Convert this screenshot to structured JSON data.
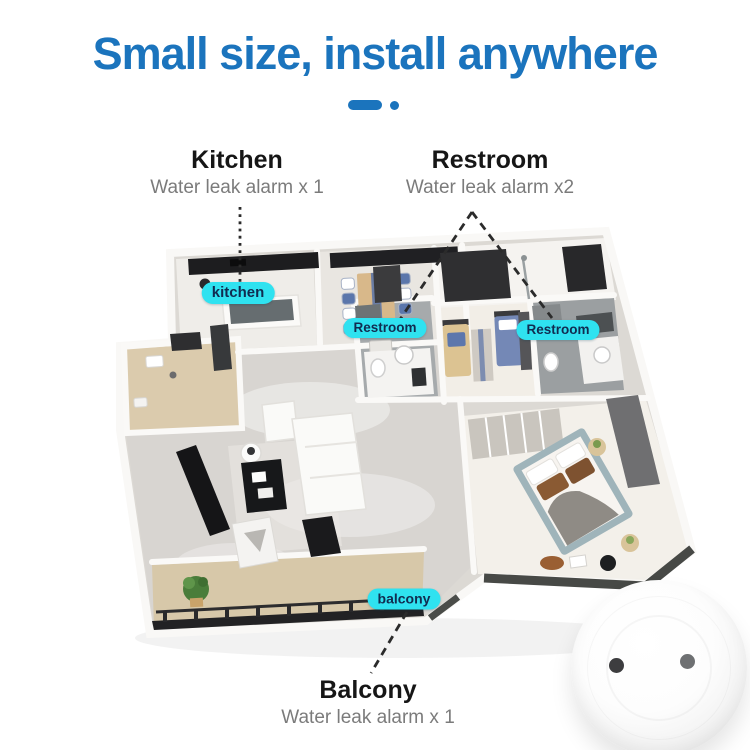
{
  "title": {
    "text": "Small size, install anywhere",
    "color": "#1b74bd"
  },
  "callouts": {
    "kitchen": {
      "heading": "Kitchen",
      "subtitle": "Water leak alarm x 1"
    },
    "restroom": {
      "heading": "Restroom",
      "subtitle": "Water leak alarm x2"
    },
    "balcony": {
      "heading": "Balcony",
      "subtitle": "Water leak alarm x 1"
    }
  },
  "room_badges": {
    "kitchen": "kitchen",
    "restroom_left": "Restroom",
    "restroom_right": "Restroom",
    "balcony": "balcony"
  },
  "colors": {
    "title_blue": "#1b74bd",
    "badge_cyan": "#2fe2f0",
    "badge_text_navy": "#112c50",
    "heading_text": "#161616",
    "subtitle_gray": "#7b7b7b"
  },
  "product": {
    "icon": "water-leak-sensor-disc"
  }
}
